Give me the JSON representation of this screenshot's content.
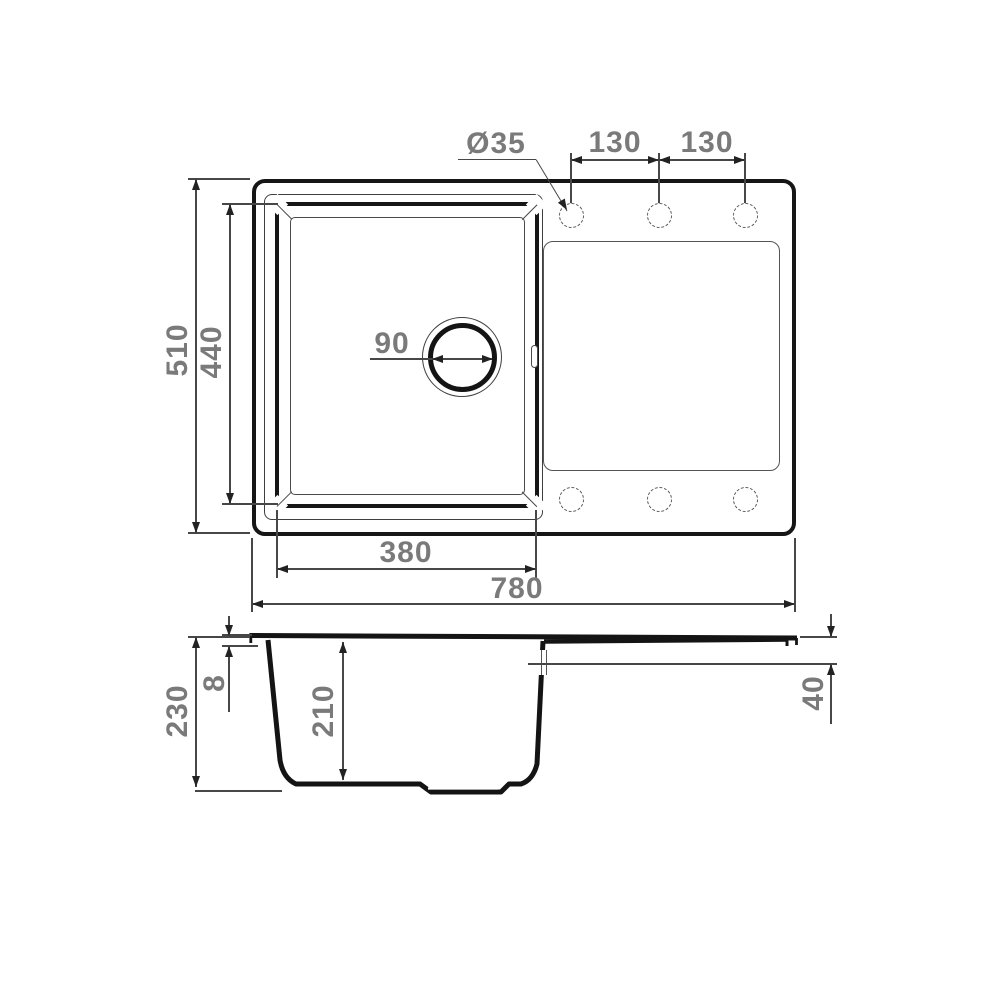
{
  "diagram": {
    "type": "kitchen sink installation drawing",
    "top_view": {
      "dim_height_overall": "510",
      "dim_height_bowl": "440",
      "dim_width_bowl": "380",
      "dim_width_overall": "780",
      "dim_faucet_hole_diameter": "Ø35",
      "dim_hole_spacing_left": "130",
      "dim_hole_spacing_right": "130",
      "dim_drain_diameter": "90"
    },
    "section_view": {
      "dim_depth_overall": "230",
      "dim_rim_edge": "8",
      "dim_bowl_depth": "210",
      "dim_drainer_drop": "40"
    },
    "colors": {
      "outline": "#161616",
      "thin_line": "#474747",
      "dimension_text": "#7a7a7a",
      "background": "#ffffff"
    }
  }
}
